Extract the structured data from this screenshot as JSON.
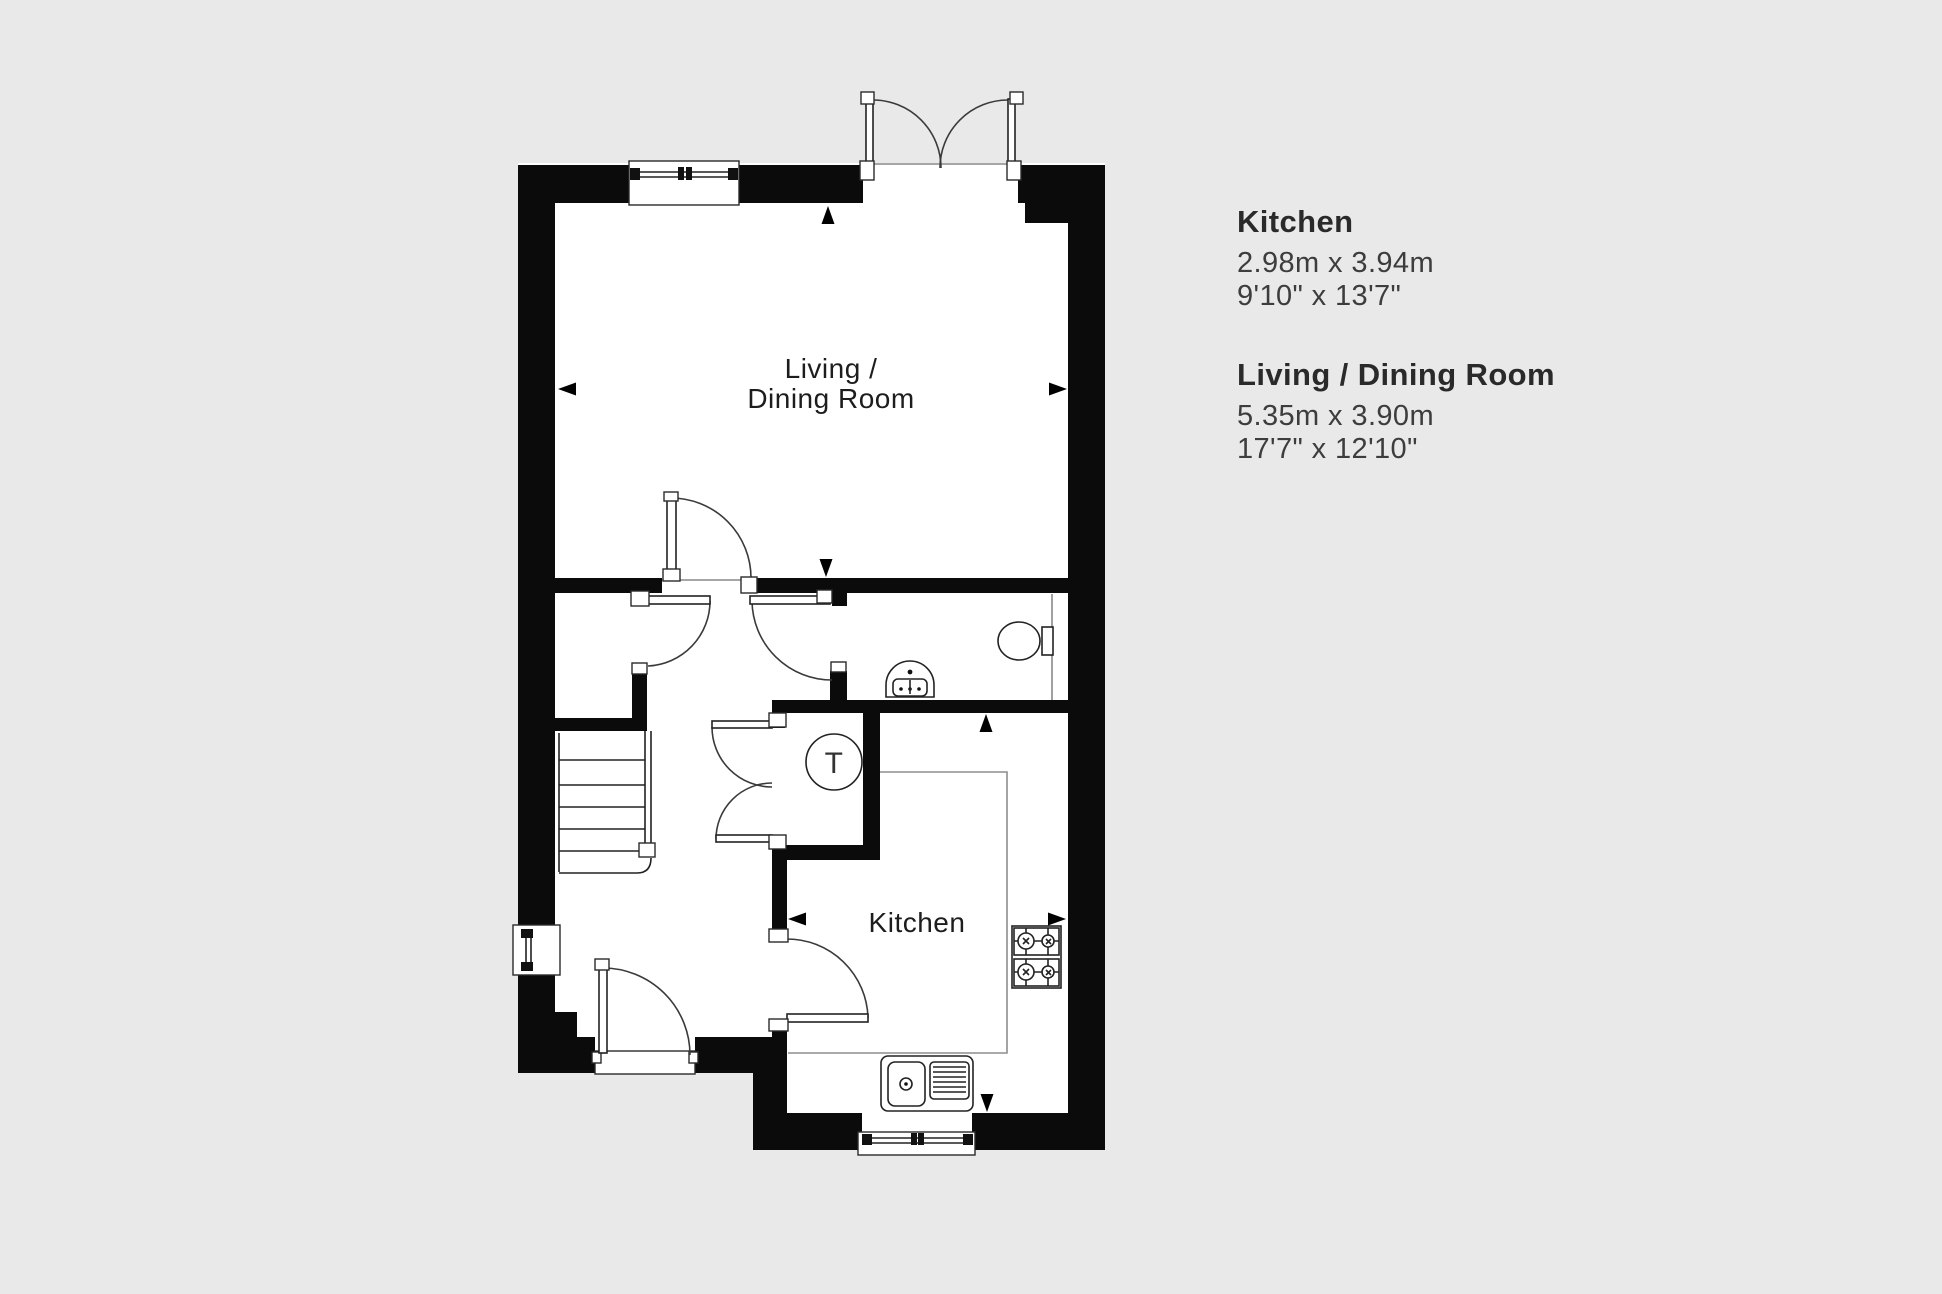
{
  "page": {
    "background": "#e9e9e9"
  },
  "plan": {
    "wall_color": "#0b0b0b",
    "floor_color": "#ffffff",
    "line_color": "#222222",
    "counter_line_color": "#8e8e8e",
    "labels": {
      "living_dining_line1": "Living /",
      "living_dining_line2": "Dining Room",
      "kitchen": "Kitchen",
      "dryer": "T"
    }
  },
  "legend": {
    "rooms": [
      {
        "name": "Kitchen",
        "metric": "2.98m x 3.94m",
        "imperial": "9'10\" x 13'7\""
      },
      {
        "name": "Living / Dining Room",
        "metric": "5.35m x 3.90m",
        "imperial": "17'7\" x 12'10\""
      }
    ]
  }
}
